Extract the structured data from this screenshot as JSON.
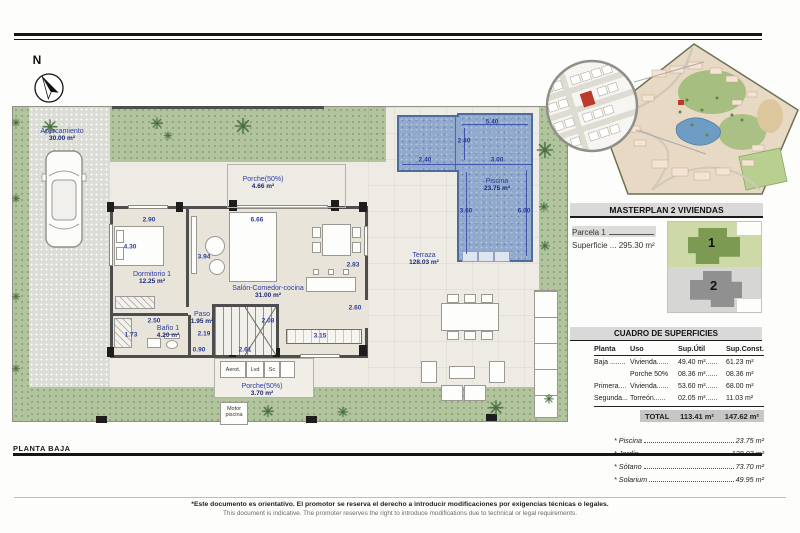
{
  "titles": {
    "planta_baja": "PLANTA BAJA"
  },
  "compass": {
    "n": "N"
  },
  "icons": {
    "palm": "✳"
  },
  "plan": {
    "rooms": {
      "aparcamiento": {
        "name": "Aparcamiento",
        "area": "30.00 m²"
      },
      "porche_top": {
        "name": "Porche(50%)",
        "area": "4.66 m²"
      },
      "dormitorio1": {
        "name": "Dormitorio 1",
        "area": "12.25 m²"
      },
      "salon": {
        "name": "Salón-Comedor-cocina",
        "area": "31.00 m²"
      },
      "paso": {
        "name": "Paso",
        "area": "1.95 m²"
      },
      "bano1": {
        "name": "Baño 1",
        "area": "4.20 m²"
      },
      "porche_bottom": {
        "name": "Porche(50%)",
        "area": "3.70 m²"
      },
      "terraza": {
        "name": "Terraza",
        "area": "128.03 m²"
      },
      "piscina": {
        "name": "Piscina",
        "area": "23.75 m²"
      }
    },
    "utilities": {
      "aerot": "Aerot.",
      "lvd": "Lvd",
      "sc": "Sc",
      "motor1": "Motor",
      "motor2": "piscina"
    },
    "dims": {
      "w290": "2.90",
      "w666": "6.66",
      "h430": "4.30",
      "h394": "3.94",
      "h283": "2.83",
      "w250": "2.50",
      "w219": "2.19",
      "h173": "1.73",
      "w090": "0.90",
      "w261": "2.61",
      "h208": "2.08",
      "h260": "2.60",
      "w315": "3.15",
      "w540": "5.40",
      "h240": "2.40",
      "w240": "2.40",
      "w300": "3.00",
      "h360": "3.60",
      "h600": "6.00"
    }
  },
  "sidebar": {
    "masterplan_title": "MASTERPLAN 2 VIVIENDAS",
    "parcela": "Parcela 1",
    "superficie": "Superficie ... 295.30 m²",
    "unit1": "1",
    "unit2": "2",
    "cuadro_title": "CUADRO DE SUPERFICIES",
    "table": {
      "headers": {
        "planta": "Planta",
        "uso": "Uso",
        "util": "Sup.Útil",
        "konst": "Sup.Const."
      },
      "rows": [
        {
          "planta": "Baja ........",
          "uso": "Vivienda......",
          "util": "49.40 m²......",
          "konst": "61.23 m²"
        },
        {
          "planta": "",
          "uso": "Porche 50%",
          "util": "08.36 m²......",
          "konst": "08.36 m²"
        },
        {
          "planta": "Primera....",
          "uso": "Vivienda......",
          "util": "53.60 m²......",
          "konst": "68.00 m²"
        },
        {
          "planta": "Segunda...",
          "uso": "Torreón......",
          "util": "02.05 m²......",
          "konst": "11.03 m²"
        }
      ],
      "total": {
        "label": "TOTAL",
        "util": "113.41 m²",
        "konst": "147.62 m²"
      }
    },
    "extras": [
      {
        "label": "* Piscina",
        "value": "23.75 m²"
      },
      {
        "label": "* Jardín",
        "value": "128.03 m²"
      },
      {
        "label": "* Sótano",
        "value": "73.70 m²"
      },
      {
        "label": "* Solarium",
        "value": "49.95 m²"
      }
    ]
  },
  "footer": {
    "line1": "*Este documento es orientativo. El promotor se reserva el derecho a introducir modificaciones por exigencias técnicas o legales.",
    "line2": "This document is indicative. The promoter reserves the right to introduce modifications due to technical or legal requirements."
  },
  "colors": {
    "dimension_blue": "#2c3c9c",
    "pool_blue": "#91a9cc",
    "garden_green": "#b2c49e",
    "parcel_red": "#bb3a2c",
    "header_gray": "#d9d9d9"
  }
}
